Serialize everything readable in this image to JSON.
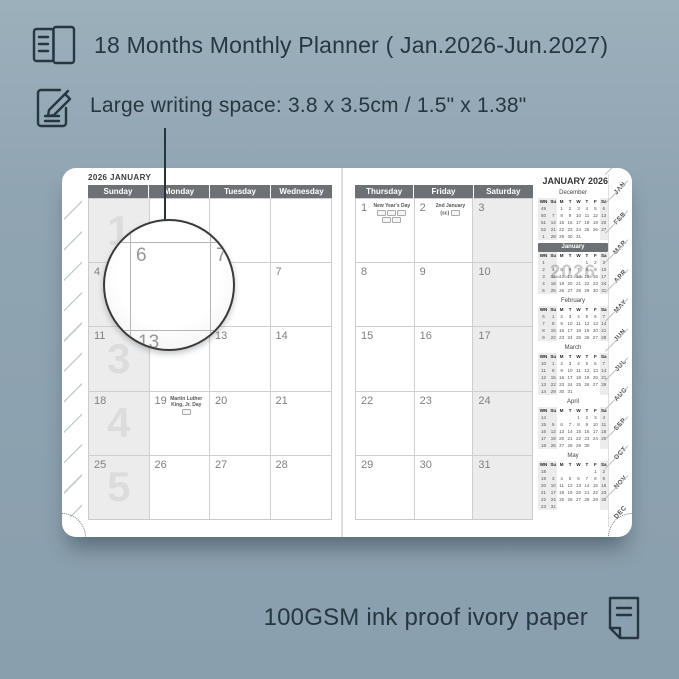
{
  "colors": {
    "background": "#90a5b2",
    "ink": "#263741",
    "page": "#ffffff",
    "header_band": "#6d7175",
    "weekend_shade": "#ececec",
    "grid_line": "#cfcfcf",
    "ghost_number": "#dcdcdc"
  },
  "annotations": {
    "title": "18 Months Monthly Planner ( Jan.2026-Jun.2027)",
    "feature": "Large writing space: 3.8 x 3.5cm / 1.5\" x 1.38\"",
    "paper": "100GSM ink proof ivory paper"
  },
  "magnifier": {
    "numbers": [
      "6",
      "7",
      "13",
      "14"
    ]
  },
  "planner": {
    "left_page": {
      "title": "2026 JANUARY",
      "day_headers": [
        "Sunday",
        "Monday",
        "Tuesday",
        "Wednesday"
      ],
      "weeks": [
        {
          "week_ghost": "1",
          "days": [
            {
              "d": ""
            },
            {
              "d": ""
            },
            {
              "d": ""
            },
            {
              "d": ""
            }
          ]
        },
        {
          "week_ghost": "2",
          "days": [
            {
              "d": "4"
            },
            {
              "d": "5"
            },
            {
              "d": "6"
            },
            {
              "d": "7"
            }
          ]
        },
        {
          "week_ghost": "3",
          "days": [
            {
              "d": "11"
            },
            {
              "d": "12"
            },
            {
              "d": "13"
            },
            {
              "d": "14"
            }
          ]
        },
        {
          "week_ghost": "4",
          "days": [
            {
              "d": "18"
            },
            {
              "d": "19",
              "holiday": "Martin Luther King, Jr. Day",
              "badges": 1
            },
            {
              "d": "20"
            },
            {
              "d": "21"
            }
          ]
        },
        {
          "week_ghost": "5",
          "days": [
            {
              "d": "25"
            },
            {
              "d": "26"
            },
            {
              "d": "27"
            },
            {
              "d": "28"
            }
          ]
        }
      ]
    },
    "right_page": {
      "title": "JANUARY 2026",
      "day_headers": [
        "Thursday",
        "Friday",
        "Saturday"
      ],
      "weeks": [
        [
          {
            "d": "1",
            "holiday": "New Year's Day",
            "badges": 5
          },
          {
            "d": "2",
            "holiday": "2nd January (sc)",
            "badges": 1
          },
          {
            "d": "3"
          }
        ],
        [
          {
            "d": "8"
          },
          {
            "d": "9"
          },
          {
            "d": "10"
          }
        ],
        [
          {
            "d": "15"
          },
          {
            "d": "16"
          },
          {
            "d": "17"
          }
        ],
        [
          {
            "d": "22"
          },
          {
            "d": "23"
          },
          {
            "d": "24"
          }
        ],
        [
          {
            "d": "29"
          },
          {
            "d": "30"
          },
          {
            "d": "31"
          }
        ]
      ]
    },
    "mini_calendars": {
      "header": [
        "WN",
        "Su",
        "M",
        "T",
        "W",
        "T",
        "F",
        "Sa"
      ],
      "months": [
        {
          "name": "December",
          "rows": [
            [
              "49",
              "",
              "1",
              "2",
              "3",
              "4",
              "5",
              "6"
            ],
            [
              "50",
              "7",
              "8",
              "9",
              "10",
              "11",
              "12",
              "13"
            ],
            [
              "51",
              "14",
              "15",
              "16",
              "17",
              "18",
              "19",
              "20"
            ],
            [
              "52",
              "21",
              "22",
              "23",
              "24",
              "25",
              "26",
              "27"
            ],
            [
              "1",
              "28",
              "29",
              "30",
              "31",
              "",
              "",
              ""
            ]
          ]
        },
        {
          "name": "January",
          "current": true,
          "ghost": "2026",
          "rows": [
            [
              "1",
              "",
              "",
              "",
              "",
              "1",
              "2",
              "3"
            ],
            [
              "2",
              "4",
              "5",
              "6",
              "7",
              "8",
              "9",
              "10"
            ],
            [
              "3",
              "11",
              "12",
              "13",
              "14",
              "15",
              "16",
              "17"
            ],
            [
              "4",
              "18",
              "19",
              "20",
              "21",
              "22",
              "23",
              "24"
            ],
            [
              "5",
              "25",
              "26",
              "27",
              "28",
              "29",
              "30",
              "31"
            ]
          ]
        },
        {
          "name": "February",
          "rows": [
            [
              "6",
              "1",
              "2",
              "3",
              "4",
              "5",
              "6",
              "7"
            ],
            [
              "7",
              "8",
              "9",
              "10",
              "11",
              "12",
              "13",
              "14"
            ],
            [
              "8",
              "15",
              "16",
              "17",
              "18",
              "19",
              "20",
              "21"
            ],
            [
              "9",
              "22",
              "23",
              "24",
              "25",
              "26",
              "27",
              "28"
            ]
          ]
        },
        {
          "name": "March",
          "rows": [
            [
              "10",
              "1",
              "2",
              "3",
              "4",
              "5",
              "6",
              "7"
            ],
            [
              "11",
              "8",
              "9",
              "10",
              "11",
              "12",
              "13",
              "14"
            ],
            [
              "12",
              "15",
              "16",
              "17",
              "18",
              "19",
              "20",
              "21"
            ],
            [
              "13",
              "22",
              "23",
              "24",
              "25",
              "26",
              "27",
              "28"
            ],
            [
              "14",
              "29",
              "30",
              "31",
              "",
              "",
              "",
              ""
            ]
          ]
        },
        {
          "name": "April",
          "rows": [
            [
              "14",
              "",
              "",
              "",
              "1",
              "2",
              "3",
              "4"
            ],
            [
              "15",
              "5",
              "6",
              "7",
              "8",
              "9",
              "10",
              "11"
            ],
            [
              "16",
              "12",
              "13",
              "14",
              "15",
              "16",
              "17",
              "18"
            ],
            [
              "17",
              "19",
              "20",
              "21",
              "22",
              "23",
              "24",
              "25"
            ],
            [
              "18",
              "26",
              "27",
              "28",
              "29",
              "30",
              "",
              ""
            ]
          ]
        },
        {
          "name": "May",
          "rows": [
            [
              "18",
              "",
              "",
              "",
              "",
              "",
              "1",
              "2"
            ],
            [
              "19",
              "3",
              "4",
              "5",
              "6",
              "7",
              "8",
              "9"
            ],
            [
              "20",
              "10",
              "11",
              "12",
              "13",
              "14",
              "15",
              "16"
            ],
            [
              "21",
              "17",
              "18",
              "19",
              "20",
              "21",
              "22",
              "23"
            ],
            [
              "22",
              "24",
              "25",
              "26",
              "27",
              "28",
              "29",
              "30"
            ],
            [
              "23",
              "31",
              "",
              "",
              "",
              "",
              "",
              ""
            ]
          ]
        }
      ]
    },
    "tabs": [
      "JAN",
      "FEB",
      "MAR",
      "APR",
      "MAY",
      "JUN",
      "JUL",
      "AUG",
      "SEP",
      "OCT",
      "NOV",
      "DEC"
    ]
  }
}
